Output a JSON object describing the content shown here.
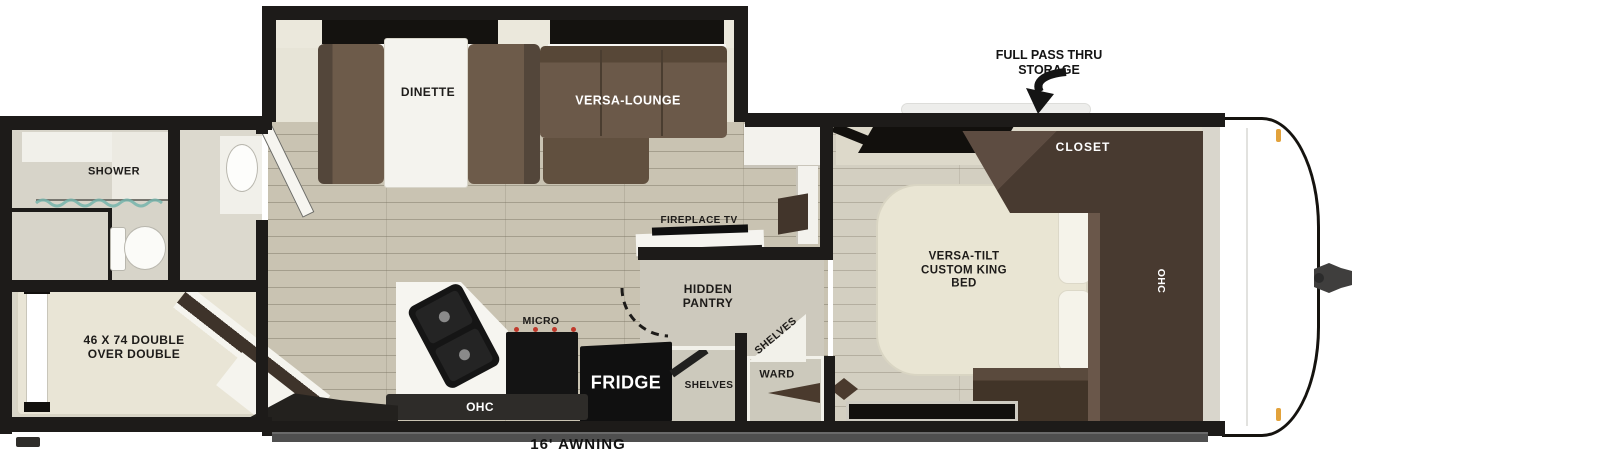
{
  "floorplan": {
    "annotations": {
      "pass_thru_storage": "FULL PASS THRU STORAGE",
      "awning": "16' AWNING"
    },
    "rooms": {
      "bathroom": {
        "shower": "SHOWER"
      },
      "bunk_room": {
        "bunk_bed": "46 X 74 DOUBLE OVER DOUBLE"
      },
      "living": {
        "dinette": "DINETTE",
        "versa_lounge": "VERSA-LOUNGE",
        "fireplace_tv": "FIREPLACE TV",
        "hidden_pantry": "HIDDEN PANTRY",
        "pantry_shelves": "SHELVES"
      },
      "kitchen": {
        "micro": "MICRO",
        "fridge": "FRIDGE",
        "ohc": "OHC",
        "shelves": "SHELVES"
      },
      "hall": {
        "ward": "WARD"
      },
      "bedroom": {
        "bed": "VERSA-TILT CUSTOM KING BED",
        "closet": "CLOSET",
        "ohc": "OHC"
      }
    },
    "colors": {
      "wall": "#1d1b19",
      "floor_wood": "#c9c3b2",
      "floor_bedroom": "#d3cfc1",
      "sofa_brown": "#6b5949",
      "cabinet_brown": "#483a30",
      "appliance_black": "#141414",
      "bed_cream": "#e9e5d3",
      "glass_teal": "#76b4ac",
      "burner_red": "#c0392b",
      "marker_amber": "#e2a23b",
      "awning_gray": "#4f4f4f"
    }
  }
}
